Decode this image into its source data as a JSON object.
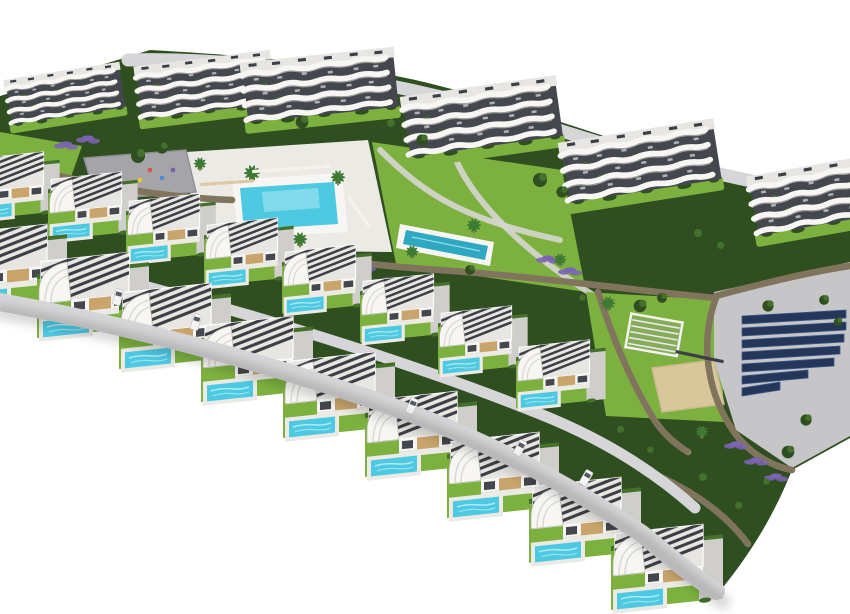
{
  "meta": {
    "description": "Aerial 3D render of a hillside residential resort: curved white apartment blocks at the back, communal pools, gardens, playground, solar panel lot, and two arcing rows of modern white villas with private pools in the foreground",
    "width": 850,
    "height": 614
  },
  "palette": {
    "bg": "#ffffff",
    "bldg_white": "#f7f6f3",
    "band_shadow": "#b5b2ac",
    "glass": "#44474d",
    "roof": "#e8e6e2",
    "slat": "#3c4046",
    "wood": "#c9a56c",
    "grass": "#7cb13f",
    "grass_dark": "#5d8f2f",
    "veg": "#2f4f21",
    "veg_light": "#44702c",
    "lavender": "#7d63b4",
    "pool": "#4ec9e2",
    "pool_light": "#aceaf3",
    "pool_deep": "#2fa8c2",
    "deck": "#eceae4",
    "paving": "#cfcecb",
    "paving2": "#c6c6c9",
    "road": "#d6d6d8",
    "stone": "#9c8c73",
    "stone_dark": "#70644f",
    "solar": "#24375a",
    "solar_light": "#3d5a8a",
    "sand": "#d9c79c",
    "plaza": "#a5a5a9",
    "car_body": "#f4f4f4",
    "shadow": "#000000"
  },
  "scene": {
    "apartments": [
      {
        "x": 2,
        "y": 78,
        "r": -9,
        "s": 0.47
      },
      {
        "x": 132,
        "y": 64,
        "r": -7,
        "s": 0.55
      },
      {
        "x": 238,
        "y": 60,
        "r": -6,
        "s": 0.62
      },
      {
        "x": 398,
        "y": 94,
        "r": -8,
        "s": 0.63
      },
      {
        "x": 556,
        "y": 140,
        "r": -9,
        "s": 0.63
      },
      {
        "x": 744,
        "y": 174,
        "r": -10,
        "s": 0.62
      }
    ],
    "villa_rows": {
      "back": {
        "scale": 0.8,
        "positions": [
          [
            -30,
            150
          ],
          [
            48,
            170
          ],
          [
            126,
            192
          ],
          [
            204,
            216
          ],
          [
            282,
            243
          ],
          [
            360,
            272
          ],
          [
            438,
            304
          ],
          [
            516,
            338
          ]
        ]
      },
      "front": {
        "scale": 1.0,
        "positions": [
          [
            -45,
            222
          ],
          [
            37,
            250
          ],
          [
            119,
            281
          ],
          [
            201,
            314
          ],
          [
            283,
            350
          ],
          [
            365,
            389
          ],
          [
            447,
            430
          ],
          [
            529,
            475
          ],
          [
            611,
            522
          ]
        ]
      }
    },
    "trees": [
      [
        138,
        156,
        1
      ],
      [
        162,
        148,
        0.8
      ],
      [
        302,
        122,
        0.9
      ],
      [
        388,
        126,
        1
      ],
      [
        422,
        140,
        0.8
      ],
      [
        540,
        180,
        1
      ],
      [
        562,
        192,
        0.8
      ],
      [
        695,
        236,
        1
      ],
      [
        718,
        248,
        0.9
      ],
      [
        640,
        306,
        0.9
      ],
      [
        662,
        298,
        0.7
      ],
      [
        768,
        306,
        0.8
      ],
      [
        60,
        196,
        0.9
      ],
      [
        100,
        206,
        0.7
      ],
      [
        230,
        250,
        0.7
      ],
      [
        470,
        270,
        0.7
      ],
      [
        580,
        300,
        0.8
      ],
      [
        618,
        432,
        0.9
      ],
      [
        648,
        452,
        0.8
      ],
      [
        700,
        480,
        1
      ],
      [
        736,
        508,
        0.9
      ],
      [
        764,
        484,
        0.8
      ],
      [
        788,
        452,
        0.9
      ],
      [
        806,
        420,
        0.8
      ],
      [
        824,
        300,
        0.7
      ],
      [
        838,
        322,
        0.6
      ]
    ],
    "palms": [
      [
        252,
        176,
        1
      ],
      [
        338,
        180,
        0.9
      ],
      [
        300,
        242,
        0.9
      ],
      [
        412,
        254,
        0.8
      ],
      [
        474,
        228,
        0.9
      ],
      [
        560,
        262,
        0.8
      ],
      [
        608,
        306,
        0.9
      ],
      [
        702,
        434,
        0.8
      ],
      [
        200,
        166,
        0.8
      ]
    ],
    "lavender": [
      [
        66,
        146
      ],
      [
        88,
        140
      ],
      [
        342,
        256
      ],
      [
        364,
        268
      ],
      [
        388,
        282
      ],
      [
        412,
        292
      ],
      [
        548,
        260
      ],
      [
        570,
        272
      ],
      [
        186,
        234
      ],
      [
        214,
        242
      ],
      [
        244,
        250
      ],
      [
        736,
        446
      ],
      [
        756,
        462
      ],
      [
        776,
        478
      ]
    ],
    "loungers": [
      {
        "x": 252,
        "y": 170,
        "r": -4,
        "n": 8,
        "gap": 10,
        "c": "#f6f3ec"
      },
      {
        "x": 200,
        "y": 183,
        "r": -4,
        "n": 6,
        "gap": 9,
        "c": "#dcc9a4"
      },
      {
        "x": 350,
        "y": 196,
        "r": 55,
        "n": 4,
        "gap": 9,
        "c": "#f6f3ec"
      },
      {
        "x": 676,
        "y": 350,
        "r": 12,
        "n": 6,
        "gap": 8,
        "c": "#3c3f45"
      }
    ],
    "cars": [
      [
        118,
        297,
        14
      ],
      [
        196,
        322,
        16
      ],
      [
        412,
        406,
        24
      ],
      [
        520,
        448,
        28
      ],
      [
        586,
        478,
        30
      ]
    ],
    "solar": {
      "x": 742,
      "y": 316,
      "step": 12,
      "rows": [
        104,
        104,
        102,
        98,
        92,
        66,
        38
      ]
    },
    "playground_dots": [
      [
        150,
        170,
        "#d9534f"
      ],
      [
        162,
        178,
        "#4a90d9"
      ],
      [
        140,
        180,
        "#e8c531"
      ],
      [
        173,
        170,
        "#7a5fae"
      ]
    ]
  }
}
